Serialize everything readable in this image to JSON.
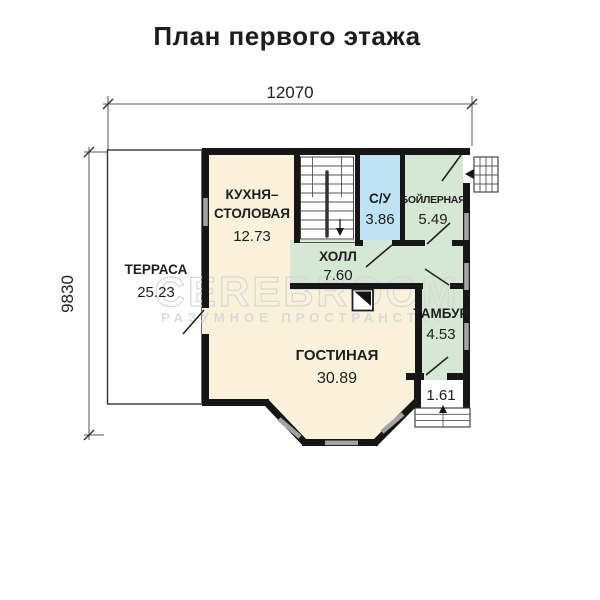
{
  "title": "План первого этажа",
  "dimensions": {
    "top": "12070",
    "left": "9830"
  },
  "rooms": {
    "terrace": {
      "name": "ТЕРРАСА",
      "area": "25.23"
    },
    "kitchen": {
      "name1": "КУХНЯ–",
      "name2": "СТОЛОВАЯ",
      "area": "12.73"
    },
    "wc": {
      "name": "С/У",
      "area": "3.86"
    },
    "boiler": {
      "name": "БОЙЛЕРНАЯ",
      "area": "5.49"
    },
    "hall": {
      "name": "ХОЛЛ",
      "area": "7.60"
    },
    "tambour": {
      "name": "ТАМБУР",
      "area": "4.53"
    },
    "living": {
      "name": "ГОСТИНАЯ",
      "area": "30.89"
    },
    "porch": {
      "area": "1.61"
    }
  },
  "watermark": {
    "line1": "CEREBROOM",
    "line2": "РАЗУМНОЕ  ПРОСТРАНСТВО"
  },
  "colors": {
    "room_cream": "#f9f1d9",
    "room_green": "#d5e8d3",
    "room_blue": "#bfe3f4",
    "wall": "#161616",
    "window": "#a3a3a3",
    "watermark": "#d7d7d7",
    "text": "#1d1d1d"
  }
}
